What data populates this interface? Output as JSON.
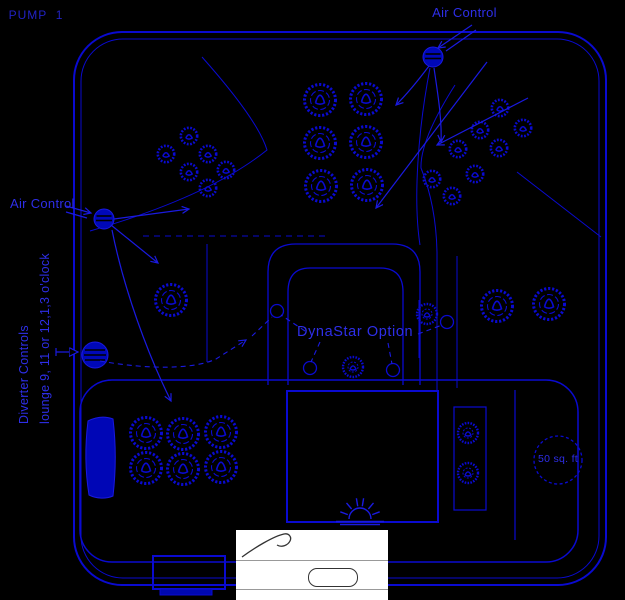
{
  "window": {
    "width": 625,
    "height": 600
  },
  "colors": {
    "background": "#000000",
    "line": "#0a0ad0",
    "knob_fill": "#0008b8",
    "label_text": "#2e2ee8",
    "overlay_bg": "#ffffff",
    "overlay_line": "#999999",
    "overlay_ink": "#333333"
  },
  "labels": {
    "air_control_top": "Air Control",
    "air_control_left": "Air Control",
    "diverter_line1": "Diverter Controls",
    "diverter_line2": "lounge 9, 11 or 12,1,3  o'clock",
    "dynastar_option": "DynaStar Option",
    "pump_1": "PUMP  1",
    "filter_size": "50 sq. ft"
  },
  "icons": {
    "air_control_knob": "striped-filled-circle",
    "diverter_knob": "striped-filled-circle",
    "spa_light": "sunburst",
    "filter": "dashed-circle",
    "jet_large": "textured-ring-jet",
    "jet_small": "textured-small-jet",
    "headrest_pillow": "filled-pad"
  }
}
